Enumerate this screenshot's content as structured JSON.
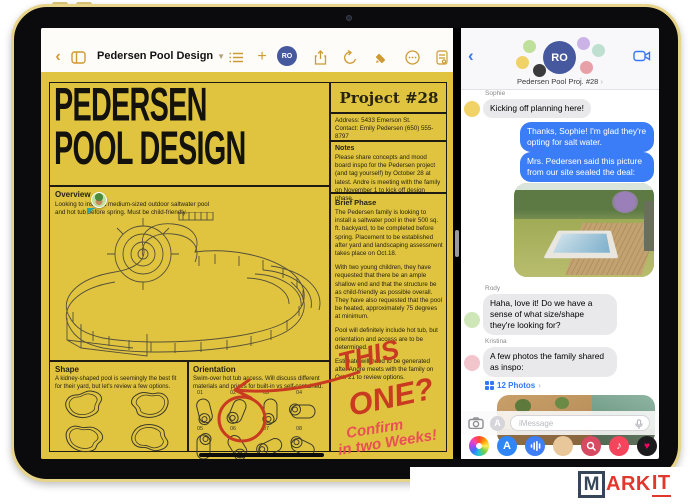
{
  "device": {
    "status": {
      "time": "9:41 AM",
      "date": "Tue Oct 18",
      "battery_pct": "100%",
      "menu_dots": "•••"
    }
  },
  "pages": {
    "toolbar": {
      "title": "Pedersen Pool Design",
      "collab_badge": "RO"
    },
    "doc": {
      "title": {
        "line1": "PEDERSEN",
        "line2": "POOL DESIGN"
      },
      "project": {
        "heading": "Project #28",
        "address": "Address: 5433 Emerson St.",
        "contact": "Contact: Emily Pedersen (650) 555-8797"
      },
      "notes": {
        "heading": "Notes",
        "body": "Please share concepts and mood board inspo for the Pedersen project (and tag yourself) by October 28 at latest. Andre is meeting with the family on November 1 to kick off design phase."
      },
      "overview": {
        "heading": "Overview",
        "body": "Looking to install a medium-sized outdoor saltwater pool and hot tub before spring. Must be child-friendly."
      },
      "brief": {
        "heading": "Brief Phase",
        "p1": "The Pedersen family is looking to install a saltwater pool in their 500 sq. ft. backyard, to be completed before spring. Placement to be established after yard and landscaping assessment takes place on Oct.18.",
        "p2": "With two young children, they have requested that there be an ample shallow end and that the structure be as child-friendly as possible overall. They have also requested that the pool be heated, approximately 75 degrees at minimum.",
        "p3": "Pool will definitely include hot tub, but orientation and access are to be determined.",
        "p4": "Estimate will need to be generated after Andre meets with the family on Oct. 21 to review options."
      },
      "shape": {
        "heading": "Shape",
        "body": "A kidney-shaped pool is seemingly the best fit for their yard, but let's review a few options."
      },
      "orientation": {
        "heading": "Orientation",
        "body": "Swim-over hot tub access. Will discuss different materials and prices for built-in vs self-contained.",
        "numbers": [
          "01",
          "02",
          "03",
          "04",
          "05",
          "06",
          "07",
          "08"
        ]
      },
      "annotation": {
        "word1": "THIS",
        "word2": "ONE?",
        "note1": "Confirm",
        "note2": "in two Weeks!"
      }
    }
  },
  "messages": {
    "header": {
      "group_name": "Pedersen Pool Proj. #28",
      "chevron": "›",
      "logo": "RO"
    },
    "chat": {
      "m1": {
        "sender": "Sophie",
        "text": "Kicking off planning here!"
      },
      "m2": {
        "text": "Thanks, Sophie! I'm glad they're opting for salt water."
      },
      "m3": {
        "text": "Mrs. Pedersen said this picture from our site sealed the deal:"
      },
      "m4": {
        "sender": "Rody",
        "text": "Haha, love it! Do we have a sense of what size/shape they're looking for?"
      },
      "m5": {
        "sender": "Kristina",
        "text": "A few photos the family shared as inspo:"
      },
      "photos_link": "12 Photos"
    },
    "composer": {
      "placeholder": "iMessage"
    }
  },
  "colors": {
    "doc_yellow": "#e0c43f",
    "accent_gold": "#cf9a33",
    "imessage_blue": "#3b7df7",
    "bubble_gray": "#e9e9eb",
    "marker_red": "#c93b21",
    "note_red": "#e85056",
    "logo_navy": "#36455a",
    "logo_red": "#e2382c"
  },
  "watermark": {
    "m": "M",
    "ark": "ARK",
    "it": "IT"
  }
}
